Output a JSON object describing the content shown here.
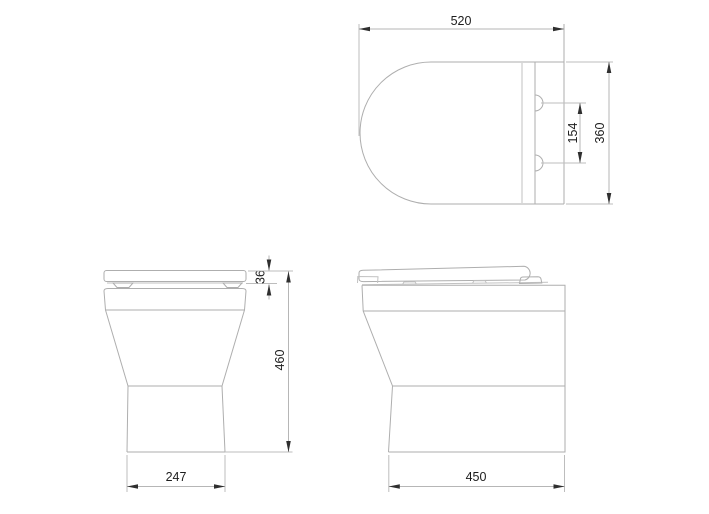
{
  "drawing": {
    "views": {
      "top": {
        "width_label": "520",
        "hinge_spacing_label": "154",
        "depth_label": "360"
      },
      "front": {
        "seat_thickness_label": "36",
        "height_label": "460",
        "base_width_label": "247"
      },
      "side": {
        "depth_label": "450"
      }
    },
    "colors": {
      "background": "#ffffff",
      "outline": "#aeaeae",
      "dimension_line": "#b6b6b6",
      "arrow": "#2f2f2f",
      "text": "#1d1d1d"
    }
  }
}
